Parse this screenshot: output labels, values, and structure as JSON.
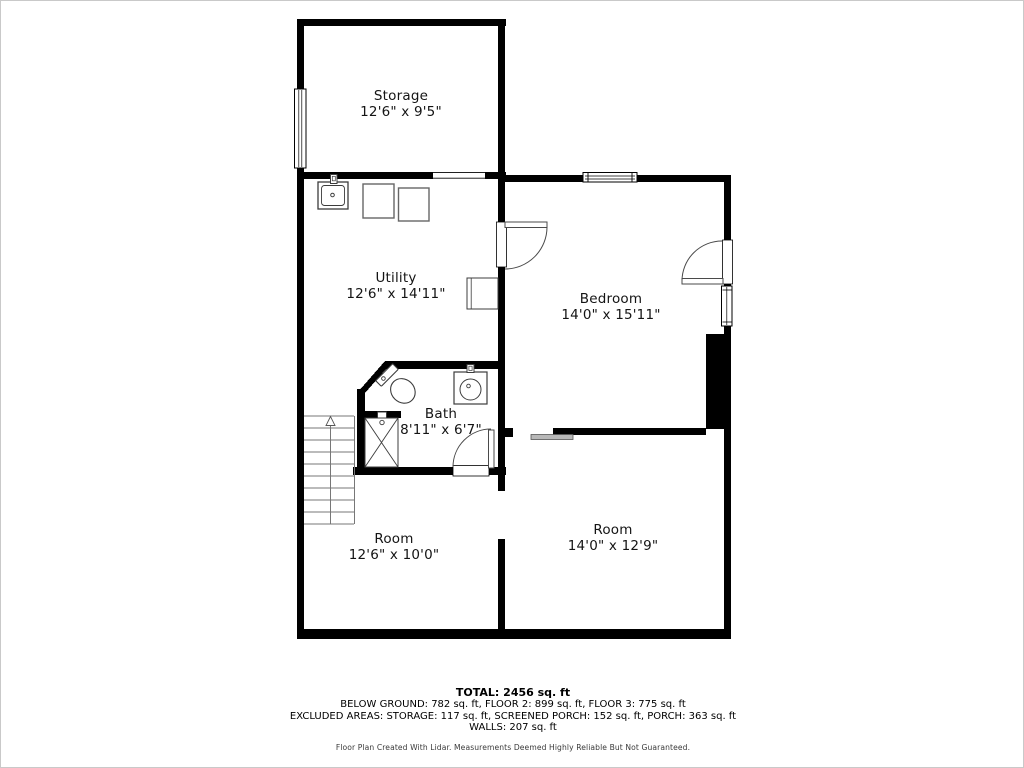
{
  "title": "Floor plan - below ground level",
  "colors": {
    "wall": "#000000",
    "background": "#ffffff",
    "fixture_line": "#3c3c3c",
    "appliance_line": "#666666",
    "stair_line": "#777777",
    "door_line": "#4a4a4a",
    "sliding_door_fill": "#b8b8b8",
    "label_text": "#141414"
  },
  "rooms": {
    "storage": {
      "name": "Storage",
      "dims": "12'6\" x 9'5\""
    },
    "utility": {
      "name": "Utility",
      "dims": "12'6\" x 14'11\""
    },
    "bedroom": {
      "name": "Bedroom",
      "dims": "14'0\" x 15'11\""
    },
    "bath": {
      "name": "Bath",
      "dims": "8'11\" x 6'7\""
    },
    "room_lower_left": {
      "name": "Room",
      "dims": "12'6\" x 10'0\""
    },
    "room_lower_right": {
      "name": "Room",
      "dims": "14'0\" x 12'9\""
    }
  },
  "fixtures": [
    "utility-sink",
    "washer",
    "dryer",
    "water-heater-unit",
    "toilet",
    "bath-sink",
    "shower",
    "staircase-up",
    "sliding-pocket-door"
  ],
  "summary": {
    "total": "TOTAL: 2456 sq. ft",
    "floors": "BELOW GROUND: 782 sq. ft, FLOOR 2: 899 sq. ft, FLOOR 3: 775 sq. ft",
    "excluded": "EXCLUDED AREAS: STORAGE: 117 sq. ft, SCREENED PORCH: 152 sq. ft, PORCH: 363 sq. ft",
    "walls": "WALLS: 207 sq. ft",
    "disclaimer": "Floor Plan Created With Lidar. Measurements Deemed Highly Reliable But Not Guaranteed."
  }
}
